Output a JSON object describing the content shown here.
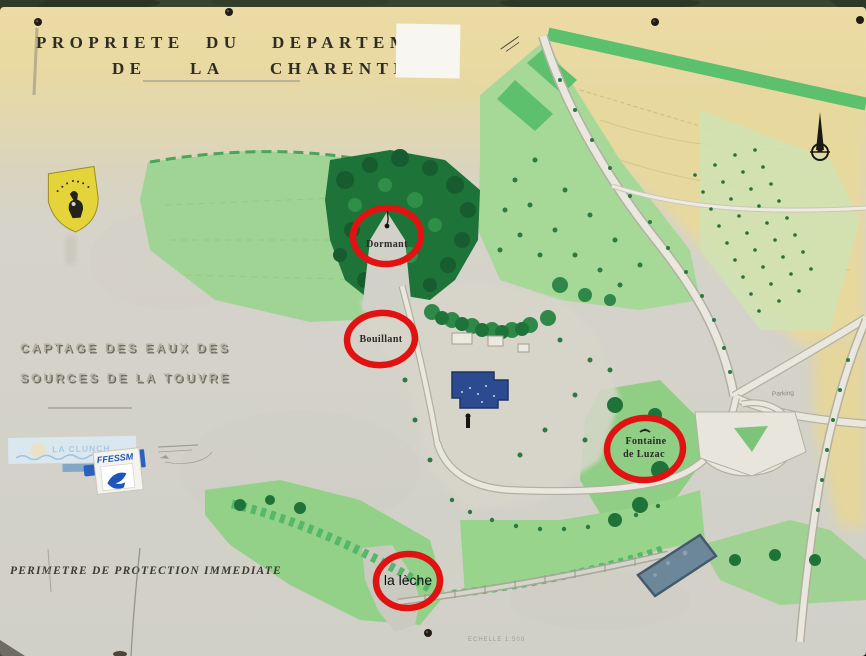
{
  "sign": {
    "title": {
      "line1": [
        "PROPRIETE",
        "DU",
        "DEPARTEM"
      ],
      "line2": [
        "DE",
        "LA",
        "CHARENTE"
      ]
    },
    "captage": {
      "line1": "CAPTAGE DES EAUX DES",
      "line2": "SOURCES DE LA TOUVRE"
    },
    "perimetre": "PERIMETRE DE PROTECTION IMMEDIATE",
    "scale": "ECHELLE 1:500"
  },
  "annotations": {
    "dormant": "Dormant",
    "bouillant": "Bouillant",
    "fontaine_line1": "Fontaine",
    "fontaine_line2": "de Luzac",
    "leche": "la lèche",
    "circle_color": "#e01212"
  },
  "map": {
    "parking_label": "Parking"
  },
  "logos": {
    "ffessm": "FFESSM",
    "banner": "LA CLUNCH"
  },
  "colors": {
    "panel_beige": "#e9d9a2",
    "panel_gray": "#d4d2ca",
    "field_green": "#9ad28c",
    "woods_green": "#1e7339",
    "tan_fields": "#e7d89e",
    "annotation_red": "#e01212",
    "building_blue": "#2b4a8f",
    "basin_blue": "#6d879a",
    "shield_yellow": "#e5d33a",
    "ffessm_blue": "#1d55b8"
  }
}
